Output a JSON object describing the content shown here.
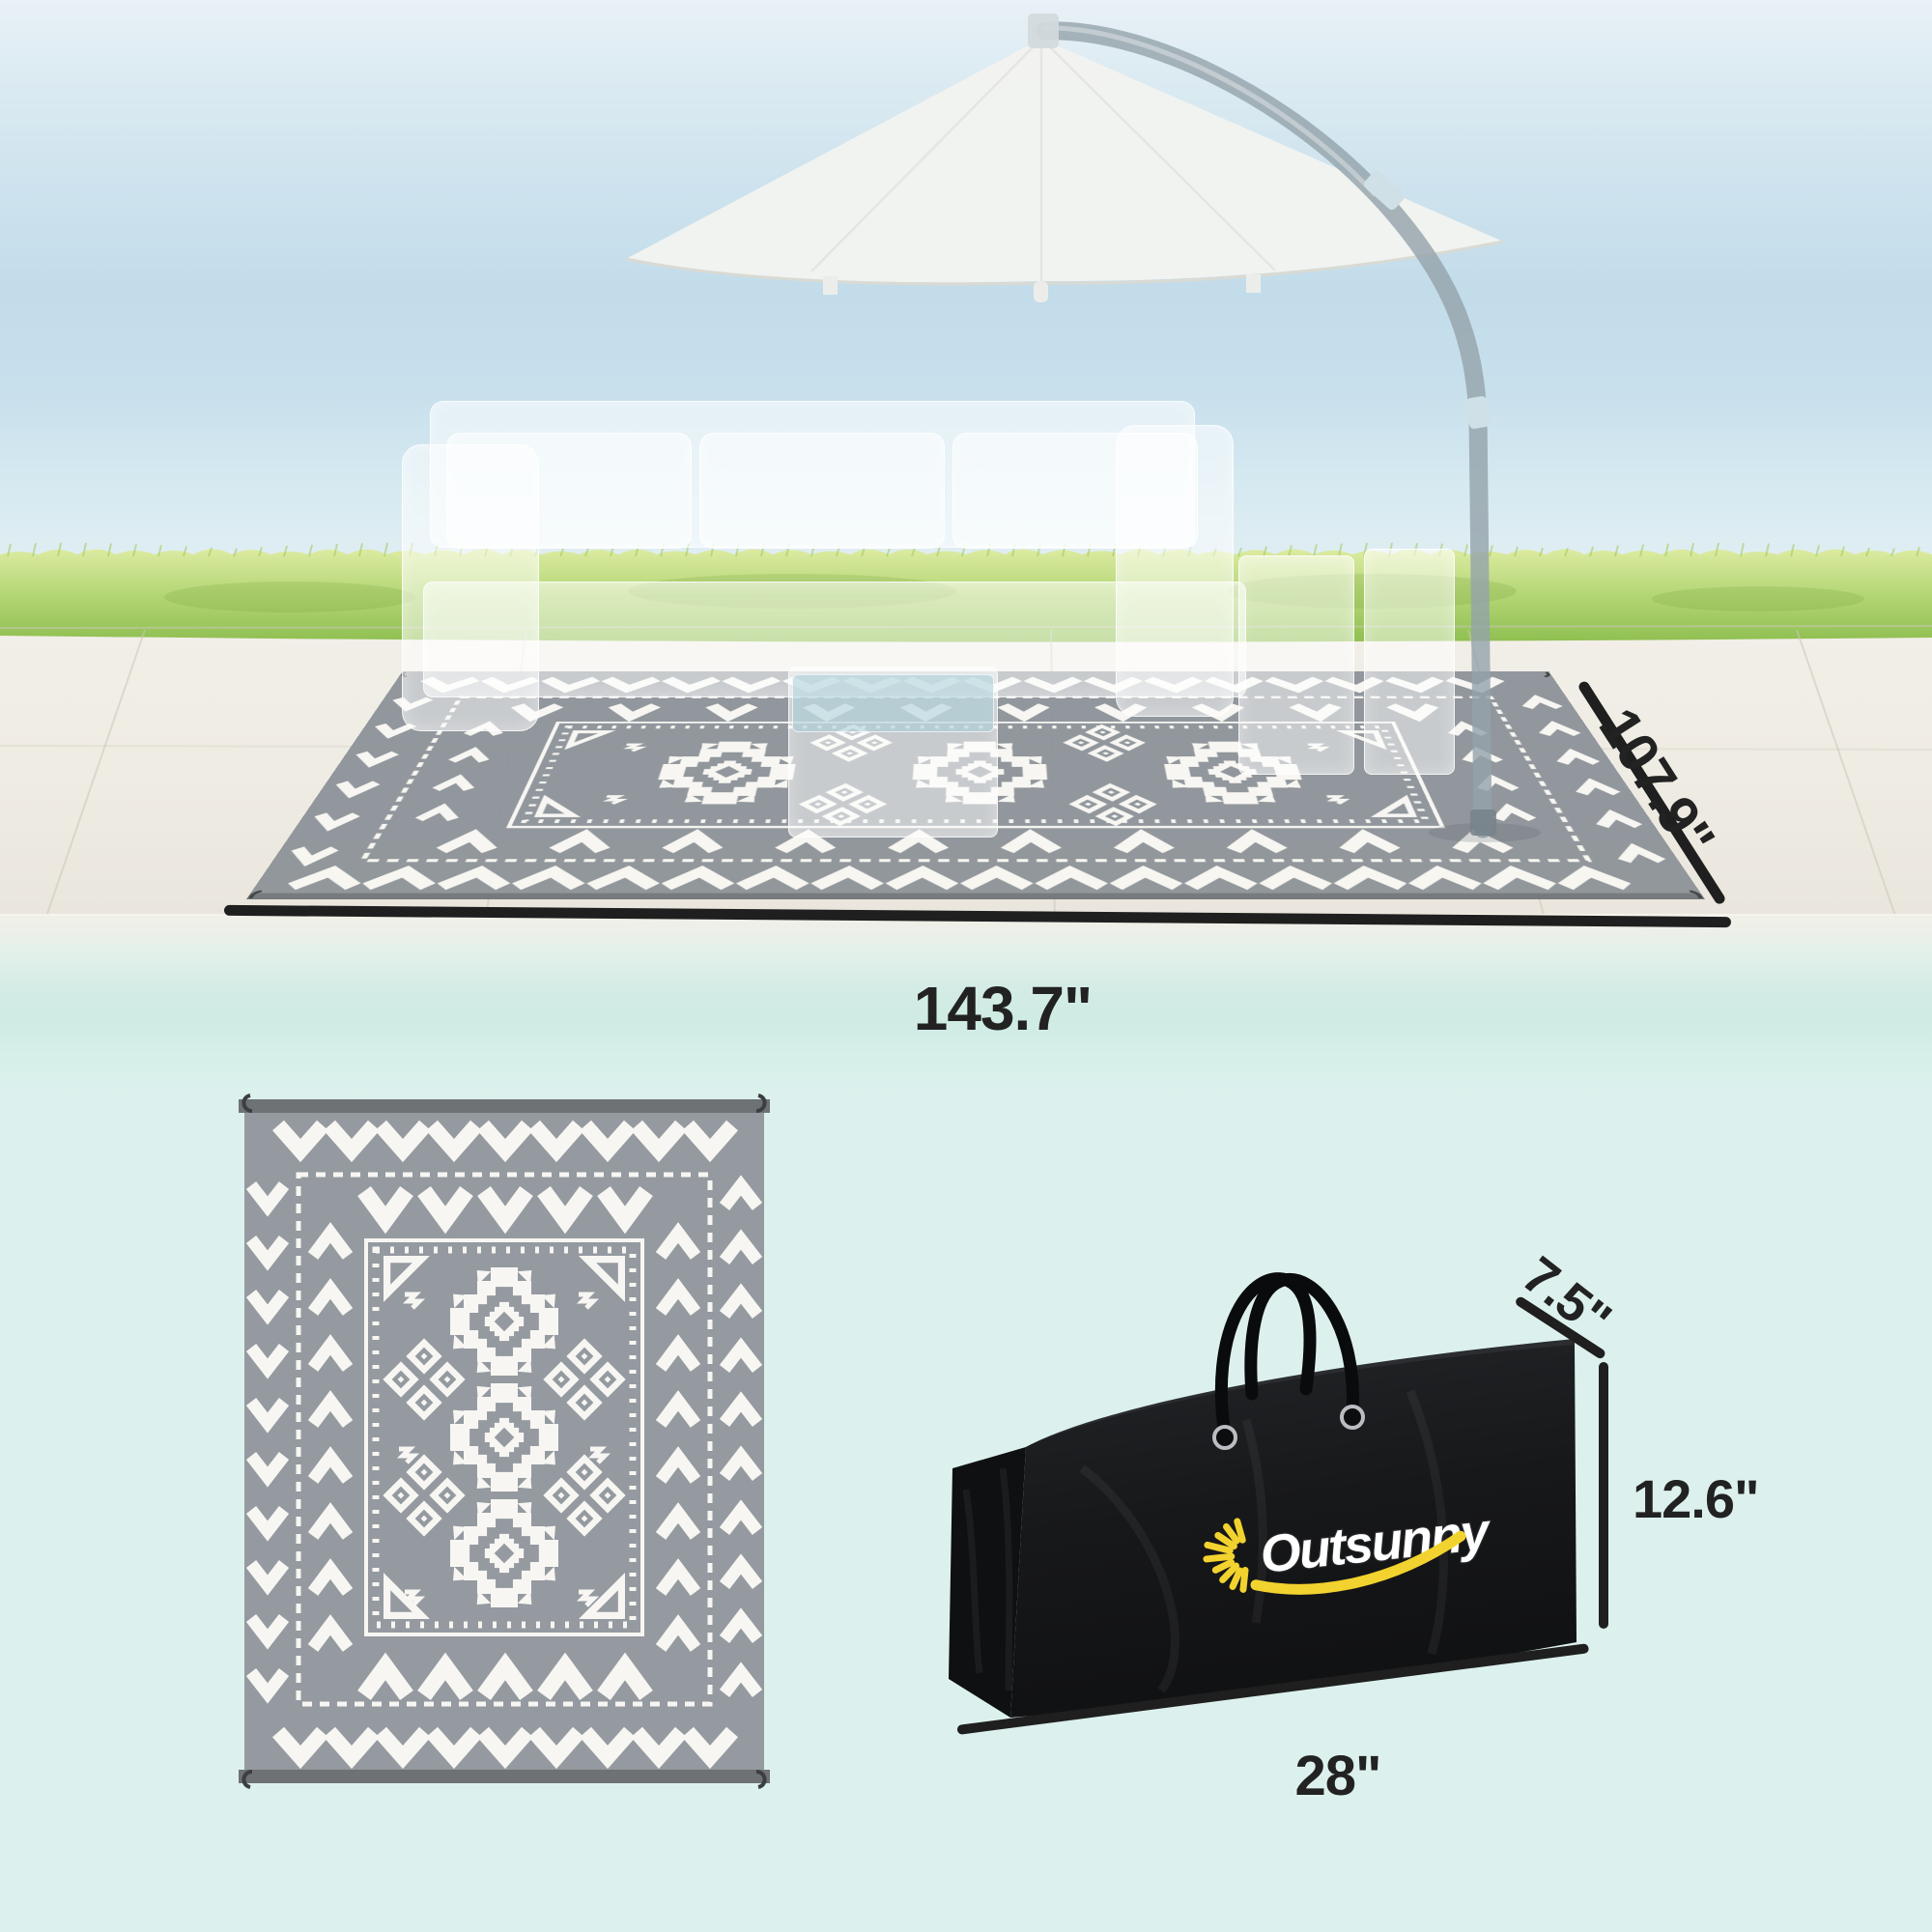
{
  "brand": {
    "name": "Outsunny"
  },
  "dimensions": {
    "rug_length_label": "143.7\"",
    "rug_width_label": "107.9\"",
    "bag_depth_label": "7.5\"",
    "bag_height_label": "12.6\"",
    "bag_length_label": "28\""
  },
  "colors": {
    "background": "#dcf1ed",
    "dimension_ink": "#1f1f1f",
    "rug_grey": "#949aa0",
    "rug_grey_persp": "#8e9499",
    "rug_white": "#f7f6f2",
    "rug_bar": "#6e7275",
    "bag_black": "#17181a",
    "logo_yellow": "#f2d22e",
    "logo_white": "#ffffff",
    "grass_green": "#9cc75d",
    "sea_blue": "#c6dfeb",
    "deck_stone": "#efece4"
  },
  "icons": {
    "logo_sun": "sunburst-rays",
    "rug_corner_hooks": "j-hook-stake-loop"
  }
}
